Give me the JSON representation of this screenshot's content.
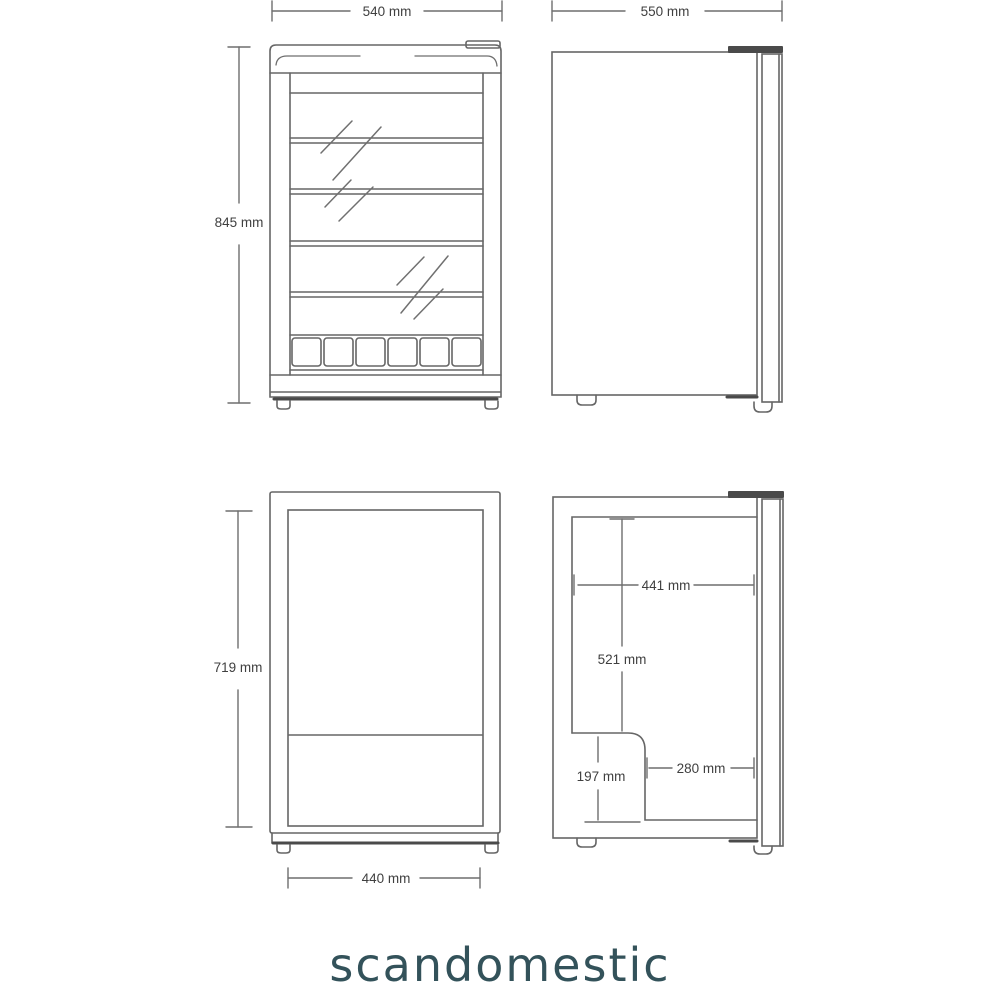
{
  "brand": {
    "logo_text": "scandomestic",
    "logo_color": "#33525a"
  },
  "drawing": {
    "line_color": "#666666",
    "dark_color": "#4a4a4a",
    "dim_text_color": "#3f3f3f"
  },
  "dimensions": {
    "front_width": "540 mm",
    "front_height": "845 mm",
    "side_depth": "550 mm",
    "interior_front_height": "719 mm",
    "interior_front_width": "440 mm",
    "interior_depth": "441 mm",
    "interior_upper_height": "521 mm",
    "compressor_height": "197 mm",
    "compressor_depth": "280 mm"
  }
}
